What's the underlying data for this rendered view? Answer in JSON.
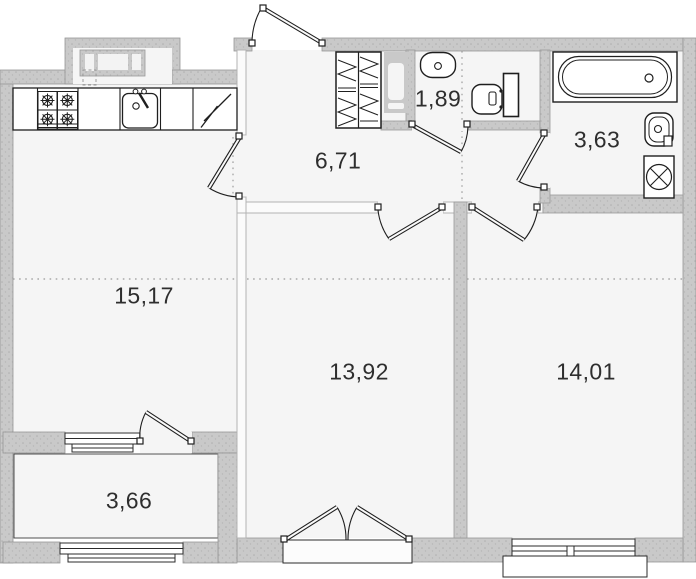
{
  "plan": {
    "title": "apartment-floor-plan",
    "rooms": [
      {
        "name": "kitchen-living-room",
        "area": "15,17"
      },
      {
        "name": "hallway",
        "area": "6,71"
      },
      {
        "name": "wc",
        "area": "1,89"
      },
      {
        "name": "bathroom",
        "area": "3,63"
      },
      {
        "name": "room-middle",
        "area": "13,92"
      },
      {
        "name": "room-right",
        "area": "14,01"
      },
      {
        "name": "balcony",
        "area": "3,66"
      }
    ],
    "fixtures": [
      "stove-4-burners",
      "kitchen-sink",
      "refrigerator",
      "wardrobe-hatched",
      "hall-cabinet",
      "wc-sink",
      "toilet",
      "bathtub",
      "bathroom-sink",
      "washing-machine"
    ],
    "openings": [
      "entrance-door",
      "kitchen-door",
      "wc-door",
      "bathroom-door",
      "room-middle-door",
      "room-right-door",
      "balcony-door",
      "double-door",
      "balcony-window-top",
      "balcony-window-bottom",
      "room-right-window",
      "niche-window"
    ],
    "colors": {
      "exterior_wall": "#c9c9c9",
      "interior_wall": "#fbfbfb",
      "floor": "#f5f5f5",
      "outline": "#1f1f1f",
      "label": "#2e2e2e",
      "background": "#ffffff"
    }
  }
}
